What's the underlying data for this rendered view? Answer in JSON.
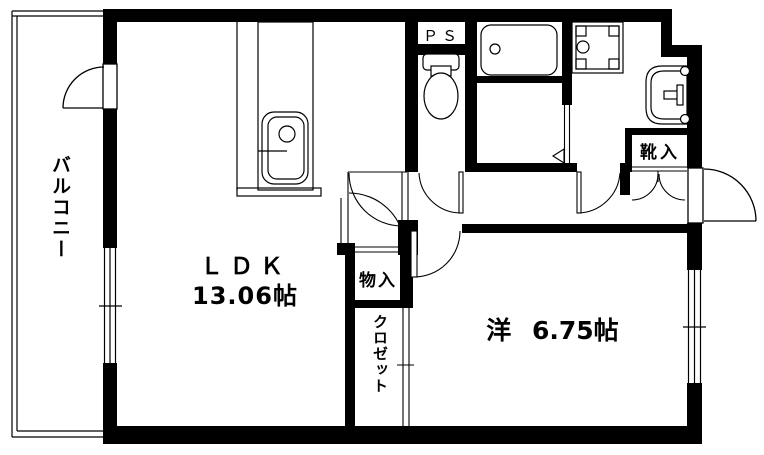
{
  "meta": {
    "type": "floorplan",
    "description": "Japanese apartment floor plan (1LDK)"
  },
  "colors": {
    "line": "#000000",
    "background": "#ffffff"
  },
  "rooms": {
    "balcony": {
      "label": "バルコニー"
    },
    "ldk": {
      "label": "ＬＤＫ",
      "size": "13.06帖"
    },
    "western_room": {
      "label": "洋 6.75帖"
    },
    "pipe_space": {
      "label": "ＰＳ"
    },
    "shoe_cabinet": {
      "label": "靴入"
    },
    "storage": {
      "label": "物入"
    },
    "closet": {
      "label": "クロゼット"
    }
  },
  "fixtures": [
    "kitchen-sink",
    "toilet",
    "bathtub",
    "washing-machine-pan",
    "washbasin"
  ]
}
